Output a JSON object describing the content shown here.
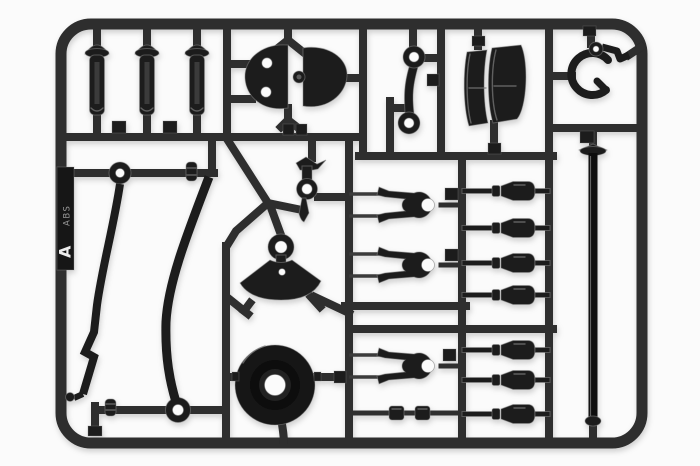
{
  "scene": {
    "description": "Black plastic model-kit parts sprue (runner) photographed on a white background",
    "type": "product-photo"
  },
  "colors": {
    "background": "#fbfbfb",
    "plastic": "#1b1b1b",
    "plastic_deep": "#0e0e0e",
    "runner": "#2d2d2d",
    "highlight": "#7a7a7a",
    "tag": "#141414",
    "tag_text": "#ededed"
  },
  "tag": {
    "letter": "A",
    "material_mark": "ABS"
  },
  "parts": [
    {
      "name": "shock-damper-body",
      "count": 3
    },
    {
      "name": "half-disc-cam",
      "count": 2
    },
    {
      "name": "dogbone-link",
      "count": 1
    },
    {
      "name": "clamp-shell-half",
      "count": 2
    },
    {
      "name": "c-clip-hook",
      "count": 1
    },
    {
      "name": "ring-grommet",
      "count": 2
    },
    {
      "name": "spool-bushing",
      "count": 2
    },
    {
      "name": "curved-stabilizer-blade",
      "count": 2
    },
    {
      "name": "steering-lever",
      "count": 1
    },
    {
      "name": "fan-cam-plate",
      "count": 1
    },
    {
      "name": "round-drum-hub",
      "count": 1
    },
    {
      "name": "suspension-wishbone",
      "count": 3
    },
    {
      "name": "ball-connector",
      "count": 7
    },
    {
      "name": "collared-shaft",
      "count": 1
    },
    {
      "name": "long-rod",
      "count": 1
    }
  ]
}
